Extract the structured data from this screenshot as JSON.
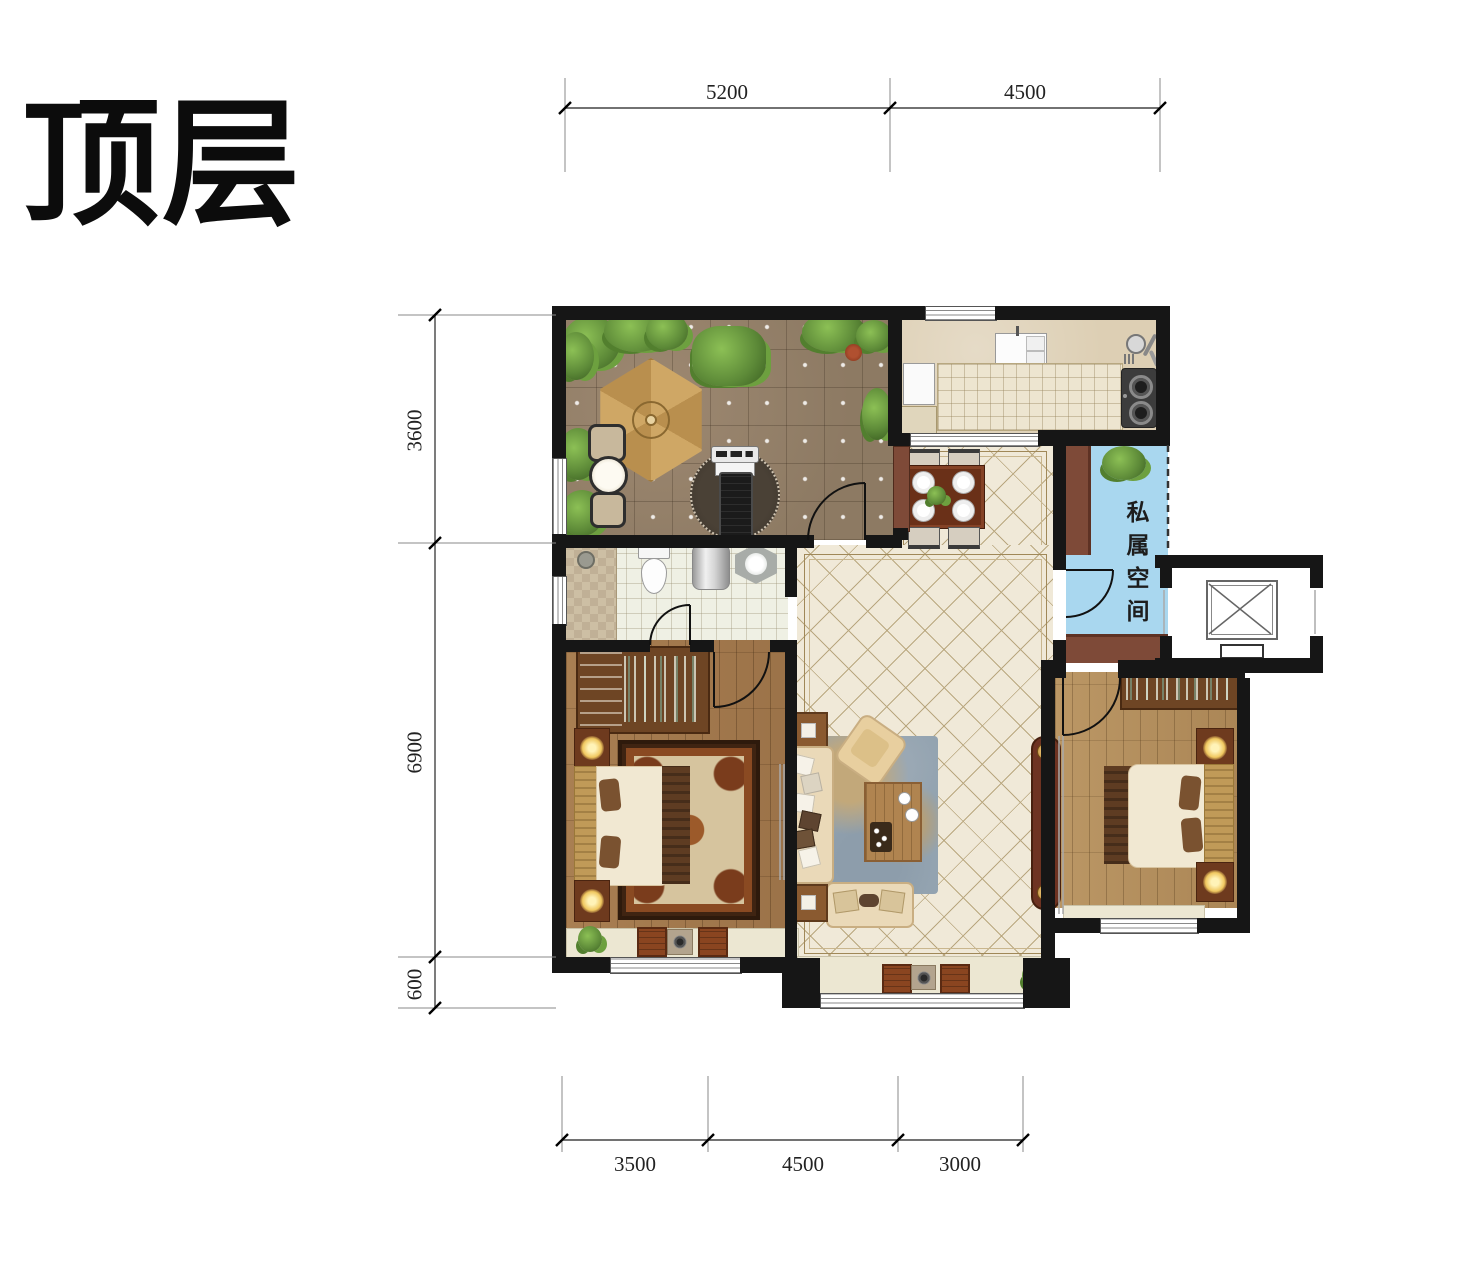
{
  "title": "顶层",
  "plan": {
    "private_space_label": "私属空间",
    "dimensions": {
      "top": [
        {
          "value": "5200"
        },
        {
          "value": "4500"
        }
      ],
      "left": [
        {
          "value": "3600"
        },
        {
          "value": "6900"
        },
        {
          "value": "600"
        }
      ],
      "bottom": [
        {
          "value": "3500"
        },
        {
          "value": "4500"
        },
        {
          "value": "3000"
        }
      ]
    },
    "colors": {
      "wall": "#161616",
      "terrace_tile": "#94806a",
      "living_tile": "#f0e9d8",
      "kitchen_floor": "#ddcfb4",
      "counter": "#ede5d0",
      "bathroom_floor": "#eff0e4",
      "wood_floor_left_bedroom": "#a97f52",
      "wood_floor_right_bedroom": "#bb9765",
      "private_space_blue": "#a9d7ef",
      "accent_wood": "#7e4a38",
      "plant_green": "#5d8a38"
    }
  }
}
